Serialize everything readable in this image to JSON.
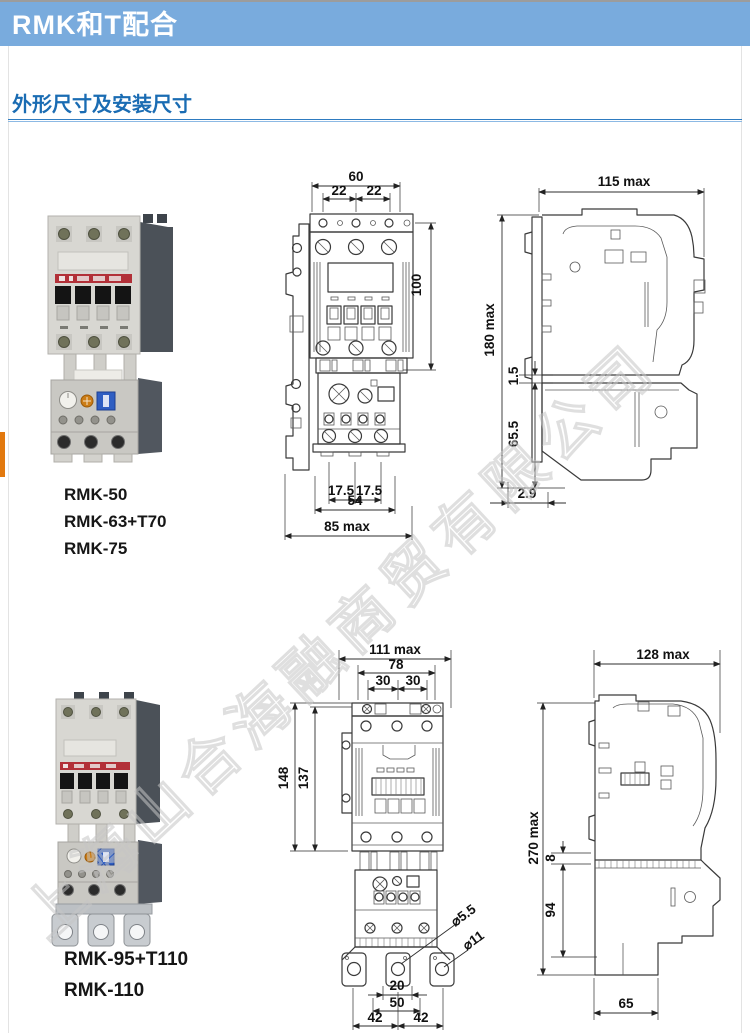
{
  "header": {
    "title": "RMK和T配合"
  },
  "section": {
    "title": "外形尺寸及安装尺寸"
  },
  "watermark": {
    "text": "上海山合海融商贸有限公司"
  },
  "colors": {
    "header_bg": "#79abdd",
    "heading_text": "#1a6cb3",
    "underline": "#2e7bc0",
    "orange_marker": "#e2790f"
  },
  "units": [
    {
      "models": [
        "RMK-50",
        "RMK-63+T70",
        "RMK-75"
      ],
      "front": {
        "top_width": "60",
        "pitch_left": "22",
        "pitch_right": "22",
        "height": "100",
        "foot_left": "17.5",
        "foot_right": "17.5",
        "mount_width": "54",
        "total_width": "85 max"
      },
      "side": {
        "depth": "115 max",
        "height": "180 max",
        "gap": "1.5",
        "relay_height": "65.5",
        "offset": "2.9"
      }
    },
    {
      "models": [
        "RMK-95+T110",
        "RMK-110"
      ],
      "front": {
        "total_width": "111 max",
        "mount_width": "78",
        "pitch_left": "30",
        "pitch_right": "30",
        "height_outer": "148",
        "height_inner": "137",
        "relay_height": "82",
        "hole_small": "⌀5.5",
        "hole_large": "⌀11",
        "slot_width": "20",
        "slot_span": "50",
        "lug_left": "42",
        "lug_right": "42"
      },
      "side": {
        "depth": "128 max",
        "height": "270 max",
        "gap": "8",
        "relay_height": "94",
        "base_depth": "65"
      }
    }
  ]
}
